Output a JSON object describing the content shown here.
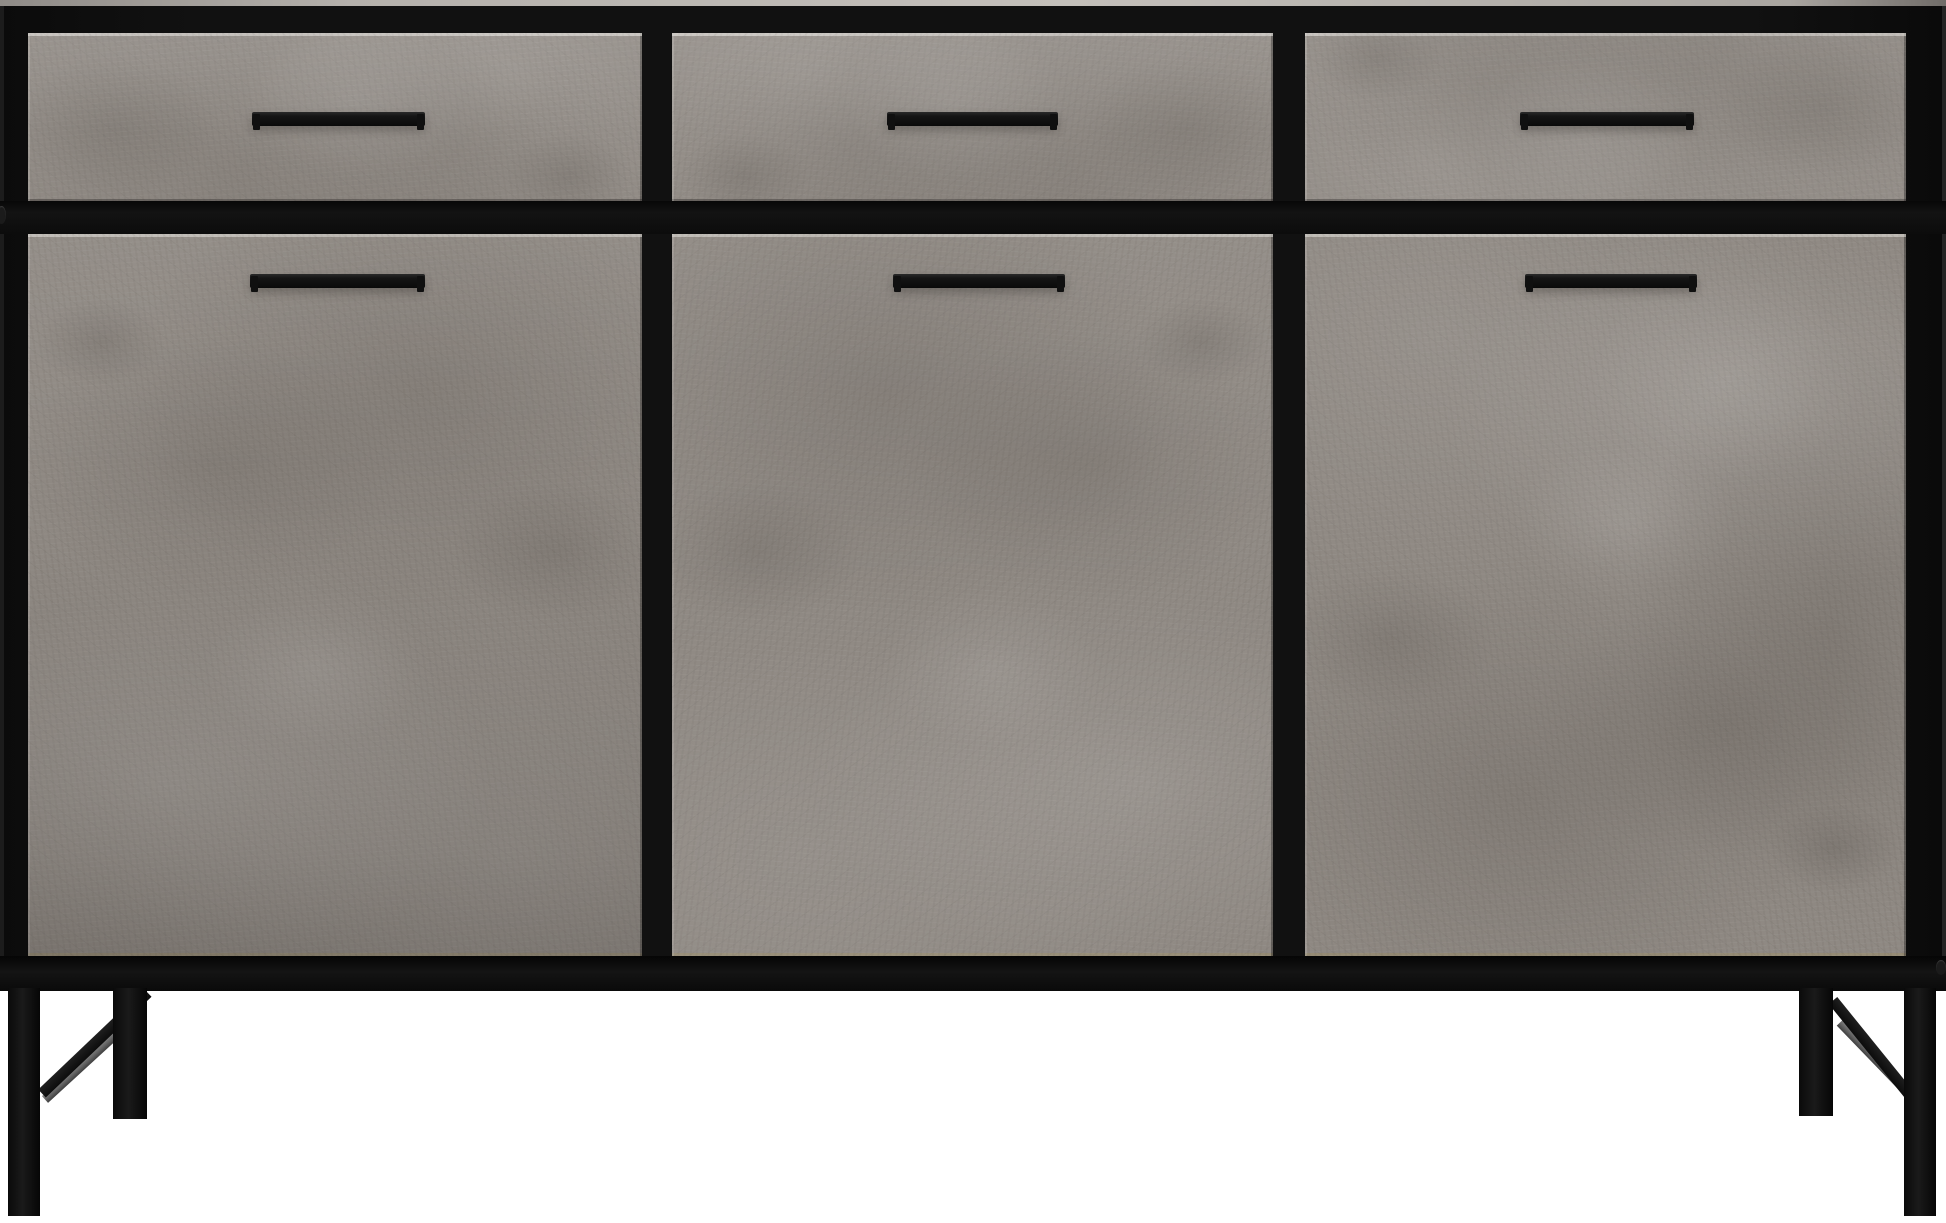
{
  "scene": {
    "subject": "Industrial style sideboard with concrete-effect panels and black metal frame",
    "description": "Front view of a wide sideboard cabinet: three drawers across the top and three cupboard doors below, each with a horizontal black bar handle, raised on angled black metal legs with diagonal cross braces, photographed on a plain white background"
  },
  "structure": {
    "drawer_count": 3,
    "door_count": 3,
    "handle_count": 6,
    "leg_count": 4,
    "sections": [
      "left",
      "center",
      "right"
    ]
  },
  "colors": {
    "background": "#ffffff",
    "frame_black": "#111111",
    "top_edge_light": "#b5b1ac",
    "concrete_base": "#8f8983",
    "concrete_light": "#a39d97",
    "concrete_dark": "#6e6963",
    "panel_edge_light": "#d2cec9",
    "panel_edge_warm": "#9a8c69",
    "handle_black": "#151515",
    "leg_black": "#121212",
    "brace_gray": "#5f5f5f"
  }
}
